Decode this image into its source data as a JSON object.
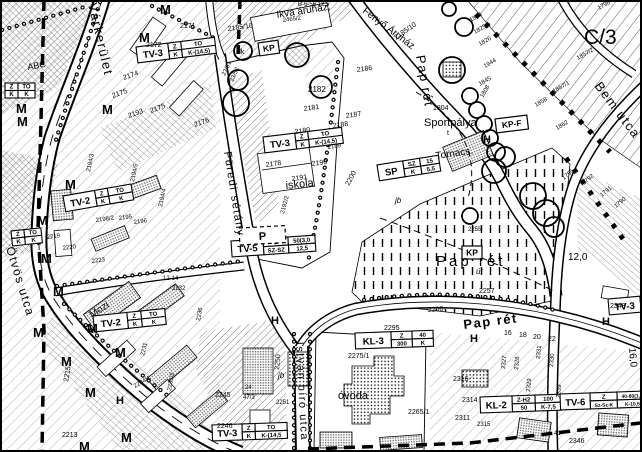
{
  "streets": [
    {
      "name": "Várkerület"
    },
    {
      "name": "Ötvös utca"
    },
    {
      "name": "Füredi sétány"
    },
    {
      "name": "Pap rét"
    },
    {
      "name": "Pap rét"
    },
    {
      "name": "Bem utca"
    },
    {
      "name": "István bíró utca"
    }
  ],
  "areas": [
    {
      "name": "Ikva áruház."
    },
    {
      "name": "Fenyő Áruház"
    },
    {
      "name": "Sportpálya"
    },
    {
      "name": "Tornacs."
    },
    {
      "name": "iskola"
    },
    {
      "name": "óvoda"
    },
    {
      "name": "Mozi"
    },
    {
      "name": "ABC"
    },
    {
      "name": "Pap rét"
    },
    {
      "name": "C/3"
    }
  ],
  "zone_boxes": [
    {
      "code": "TV-3",
      "cells": [
        "Z",
        "TO",
        "K",
        "K-(14,5)"
      ]
    },
    {
      "code": "TV-3",
      "cells": [
        "Z",
        "TO",
        "K",
        "K-(14,5)"
      ]
    },
    {
      "code": "TV-2",
      "cells": [
        "Z",
        "TO",
        "K",
        "K"
      ]
    },
    {
      "code": "TV-5",
      "cells": [
        "Z",
        "50(3,0",
        "SZ-SZ",
        "12,5"
      ]
    },
    {
      "code": "SP",
      "cells": [
        "SZ",
        "15",
        "K",
        "5,5"
      ]
    },
    {
      "code": "TV-2",
      "cells": [
        "Z",
        "TO",
        "K",
        "K"
      ]
    },
    {
      "code": "KL-3",
      "cells": [
        "Z",
        "40",
        "300",
        "K"
      ]
    },
    {
      "code": "KL-2",
      "cells": [
        "Z-H2",
        "100",
        "50",
        "K-7,5"
      ]
    },
    {
      "code": "TV-6",
      "cells": [
        "Z",
        "40-80(1,8",
        "Sz-Sz-K",
        "K-10,5"
      ]
    },
    {
      "code": "TV-3",
      "cells": [
        "Z",
        "TO",
        "K",
        "K-(14,5"
      ]
    },
    {
      "code": "TV-3",
      "cells": [
        "Z",
        "TO",
        "K",
        "K-(14,5)"
      ]
    },
    {
      "code": "",
      "cells": [
        "Z",
        "TO",
        "K",
        "K"
      ]
    },
    {
      "code": "",
      "cells": [
        "Z",
        "TO",
        "K",
        "K"
      ]
    }
  ],
  "simple_boxes": [
    {
      "label": "KP"
    },
    {
      "label": "KP-F"
    },
    {
      "label": "KP"
    },
    {
      "label": "P"
    }
  ],
  "markers": [
    {
      "t": "M",
      "x": 160,
      "y": 14
    },
    {
      "t": "M",
      "x": 139,
      "y": 42
    },
    {
      "t": "M",
      "x": 16,
      "y": 113
    },
    {
      "t": "M",
      "x": 102,
      "y": 114
    },
    {
      "t": "M",
      "x": 17,
      "y": 126
    },
    {
      "t": "M",
      "x": 65,
      "y": 189
    },
    {
      "t": "M",
      "x": 37,
      "y": 225
    },
    {
      "t": "M",
      "x": 41,
      "y": 263
    },
    {
      "t": "M",
      "x": 53,
      "y": 296
    },
    {
      "t": "M",
      "x": 87,
      "y": 333
    },
    {
      "t": "M",
      "x": 33,
      "y": 337
    },
    {
      "t": "M",
      "x": 61,
      "y": 366
    },
    {
      "t": "M",
      "x": 115,
      "y": 357
    },
    {
      "t": "M",
      "x": 85,
      "y": 397
    },
    {
      "t": "M",
      "x": 121,
      "y": 442
    },
    {
      "t": "M",
      "x": 79,
      "y": 451
    },
    {
      "t": "H",
      "x": 116,
      "y": 404,
      "s": 11
    },
    {
      "t": "H",
      "x": 271,
      "y": 324,
      "s": 11
    },
    {
      "t": "H",
      "x": 470,
      "y": 342,
      "s": 11
    },
    {
      "t": "H",
      "x": 602,
      "y": 325,
      "s": 11
    },
    {
      "t": "H",
      "x": 483,
      "y": 143,
      "s": 11
    }
  ],
  "small_labels": [
    {
      "t": "2171",
      "x": 180,
      "y": 28
    },
    {
      "t": "2172",
      "x": 146,
      "y": 47
    },
    {
      "t": "2174",
      "x": 124,
      "y": 80,
      "r": -20
    },
    {
      "t": "2175",
      "x": 113,
      "y": 98,
      "r": -20
    },
    {
      "t": "2175",
      "x": 151,
      "y": 113,
      "r": -20
    },
    {
      "t": "2176",
      "x": 195,
      "y": 127,
      "r": -20
    },
    {
      "t": "2193",
      "x": 129,
      "y": 118,
      "r": -20
    },
    {
      "t": "2178",
      "x": 266,
      "y": 167,
      "r": -8
    },
    {
      "t": "2190",
      "x": 312,
      "y": 166,
      "r": -8
    },
    {
      "t": "2191",
      "x": 292,
      "y": 181,
      "r": -8
    },
    {
      "t": "2192/2",
      "x": 284,
      "y": 214,
      "r": -75,
      "s": 6
    },
    {
      "t": "2180",
      "x": 295,
      "y": 134,
      "r": -8
    },
    {
      "t": "2181",
      "x": 304,
      "y": 111,
      "r": -8
    },
    {
      "t": "2182",
      "x": 308,
      "y": 92,
      "s": 8
    },
    {
      "t": "2187",
      "x": 346,
      "y": 118,
      "r": -8
    },
    {
      "t": "2188",
      "x": 333,
      "y": 128,
      "r": -8
    },
    {
      "t": "2186",
      "x": 357,
      "y": 72,
      "r": -8
    },
    {
      "t": "2189",
      "x": 328,
      "y": 149,
      "r": -8,
      "s": 6
    },
    {
      "t": "2185/10",
      "x": 228,
      "y": 31,
      "r": -8
    },
    {
      "t": "2185/10",
      "x": 396,
      "y": 40,
      "r": -35
    },
    {
      "t": "2465/2",
      "x": 283,
      "y": 22,
      "r": -8,
      "s": 6
    },
    {
      "t": "23/51",
      "x": 225,
      "y": 76,
      "r": -65,
      "s": 6
    },
    {
      "t": "23/52",
      "x": 233,
      "y": 82,
      "r": -65,
      "s": 6
    },
    {
      "t": "1804",
      "x": 433,
      "y": 110
    },
    {
      "t": "1808",
      "x": 483,
      "y": 98,
      "r": -60,
      "s": 6
    },
    {
      "t": "1824",
      "x": 471,
      "y": 22,
      "r": -30,
      "s": 6
    },
    {
      "t": "1825/6",
      "x": 475,
      "y": 34,
      "r": -30,
      "s": 6
    },
    {
      "t": "1826",
      "x": 480,
      "y": 46,
      "r": -30,
      "s": 6
    },
    {
      "t": "1944",
      "x": 485,
      "y": 68,
      "r": -30,
      "s": 6
    },
    {
      "t": "1845",
      "x": 480,
      "y": 86,
      "r": -30,
      "s": 6
    },
    {
      "t": "1857/2",
      "x": 578,
      "y": 60,
      "r": -30,
      "s": 6
    },
    {
      "t": "1857/1",
      "x": 554,
      "y": 93,
      "r": -30,
      "s": 6
    },
    {
      "t": "1858",
      "x": 536,
      "y": 107,
      "r": -30,
      "s": 6
    },
    {
      "t": "1862",
      "x": 557,
      "y": 130,
      "r": -30,
      "s": 6
    },
    {
      "t": "1798",
      "x": 599,
      "y": 10,
      "r": -30,
      "s": 6
    },
    {
      "t": "1795",
      "x": 564,
      "y": 180,
      "r": -40,
      "s": 6
    },
    {
      "t": "1792",
      "x": 584,
      "y": 185,
      "r": -40,
      "s": 6
    },
    {
      "t": "1791",
      "x": 602,
      "y": 197,
      "r": -40,
      "s": 6
    },
    {
      "t": "1790",
      "x": 616,
      "y": 208,
      "r": -40,
      "s": 6
    },
    {
      "t": "2255",
      "x": 468,
      "y": 231,
      "s": 6
    },
    {
      "t": "2257",
      "x": 479,
      "y": 293
    },
    {
      "t": "2200",
      "x": 349,
      "y": 186,
      "r": -62
    },
    {
      "t": "2200",
      "x": 428,
      "y": 312,
      "r": -4
    },
    {
      "t": "12,0",
      "x": 568,
      "y": 260,
      "s": 10
    },
    {
      "t": "16,0",
      "x": 629,
      "y": 348,
      "r": 85,
      "s": 10
    },
    {
      "t": "2194/3",
      "x": 90,
      "y": 172,
      "r": -78,
      "s": 6
    },
    {
      "t": "2194/5",
      "x": 134,
      "y": 182,
      "r": -78,
      "s": 6
    },
    {
      "t": "2194/4",
      "x": 162,
      "y": 207,
      "r": -78,
      "s": 6
    },
    {
      "t": "2198/2",
      "x": 96,
      "y": 222,
      "r": -8,
      "s": 6
    },
    {
      "t": "2195",
      "x": 119,
      "y": 220,
      "r": -8,
      "s": 6
    },
    {
      "t": "2196",
      "x": 134,
      "y": 224,
      "r": -8,
      "s": 6
    },
    {
      "t": "2219",
      "x": 47,
      "y": 239,
      "r": -8,
      "s": 6
    },
    {
      "t": "2220",
      "x": 63,
      "y": 250,
      "r": -8,
      "s": 6
    },
    {
      "t": "2223",
      "x": 92,
      "y": 263,
      "r": -8,
      "s": 6
    },
    {
      "t": "2232",
      "x": 172,
      "y": 290,
      "s": 6
    },
    {
      "t": "12-14",
      "x": 163,
      "y": 280,
      "s": 6
    },
    {
      "t": "2215",
      "x": 68,
      "y": 382,
      "r": -80
    },
    {
      "t": "2213",
      "x": 62,
      "y": 437
    },
    {
      "t": "2231",
      "x": 144,
      "y": 356,
      "r": -75,
      "s": 6
    },
    {
      "t": "2234/1",
      "x": 135,
      "y": 388,
      "r": -30,
      "s": 6
    },
    {
      "t": "2235/2",
      "x": 171,
      "y": 391,
      "r": -80,
      "s": 6
    },
    {
      "t": "2236",
      "x": 200,
      "y": 321,
      "r": -80,
      "s": 6
    },
    {
      "t": "2245",
      "x": 215,
      "y": 397
    },
    {
      "t": "2246",
      "x": 217,
      "y": 428
    },
    {
      "t": "47/3",
      "x": 243,
      "y": 399,
      "s": 6
    },
    {
      "t": "24",
      "x": 245,
      "y": 389,
      "s": 6
    },
    {
      "t": "2250",
      "x": 279,
      "y": 370,
      "r": -85
    },
    {
      "t": "2251",
      "x": 276,
      "y": 404,
      "s": 6
    },
    {
      "t": "2275/1",
      "x": 348,
      "y": 358
    },
    {
      "t": "2295",
      "x": 384,
      "y": 330
    },
    {
      "t": "2265/1",
      "x": 408,
      "y": 414
    },
    {
      "t": "2311",
      "x": 455,
      "y": 420
    },
    {
      "t": "2314",
      "x": 462,
      "y": 402
    },
    {
      "t": "2315",
      "x": 477,
      "y": 426,
      "s": 6
    },
    {
      "t": "2316",
      "x": 453,
      "y": 381
    },
    {
      "t": "2327",
      "x": 505,
      "y": 369,
      "r": -85,
      "s": 6
    },
    {
      "t": "2328",
      "x": 518,
      "y": 370,
      "r": -85,
      "s": 6
    },
    {
      "t": "2329",
      "x": 530,
      "y": 392,
      "r": -85,
      "s": 6
    },
    {
      "t": "2331",
      "x": 540,
      "y": 359,
      "r": -85,
      "s": 6
    },
    {
      "t": "2330",
      "x": 553,
      "y": 367,
      "r": -85,
      "s": 6
    },
    {
      "t": "2339",
      "x": 560,
      "y": 398,
      "r": -85,
      "s": 6
    },
    {
      "t": "41",
      "x": 554,
      "y": 435,
      "s": 6
    },
    {
      "t": "2346",
      "x": 569,
      "y": 443
    },
    {
      "t": "2348",
      "x": 610,
      "y": 308
    },
    {
      "t": "16",
      "x": 504,
      "y": 335,
      "s": 7
    },
    {
      "t": "18",
      "x": 519,
      "y": 337,
      "s": 7
    },
    {
      "t": "20",
      "x": 533,
      "y": 339,
      "s": 7
    },
    {
      "t": "22",
      "x": 548,
      "y": 341,
      "s": 7
    },
    {
      "t": "jb",
      "x": 395,
      "y": 203,
      "s": 8,
      "i": 1
    },
    {
      "t": "jb",
      "x": 278,
      "y": 378,
      "s": 8,
      "i": 1
    },
    {
      "t": "út",
      "x": 476,
      "y": 274,
      "s": 8,
      "i": 1
    },
    {
      "t": "dk",
      "x": 237,
      "y": 54,
      "s": 7
    },
    {
      "t": "t",
      "x": 447,
      "y": 135,
      "s": 7
    },
    {
      "t": "B-6-56 12,5",
      "x": 298,
      "y": 6,
      "s": 6
    }
  ],
  "colors": {
    "ink": "#000000",
    "paper": "#ffffff",
    "building_gray": "#777777"
  }
}
